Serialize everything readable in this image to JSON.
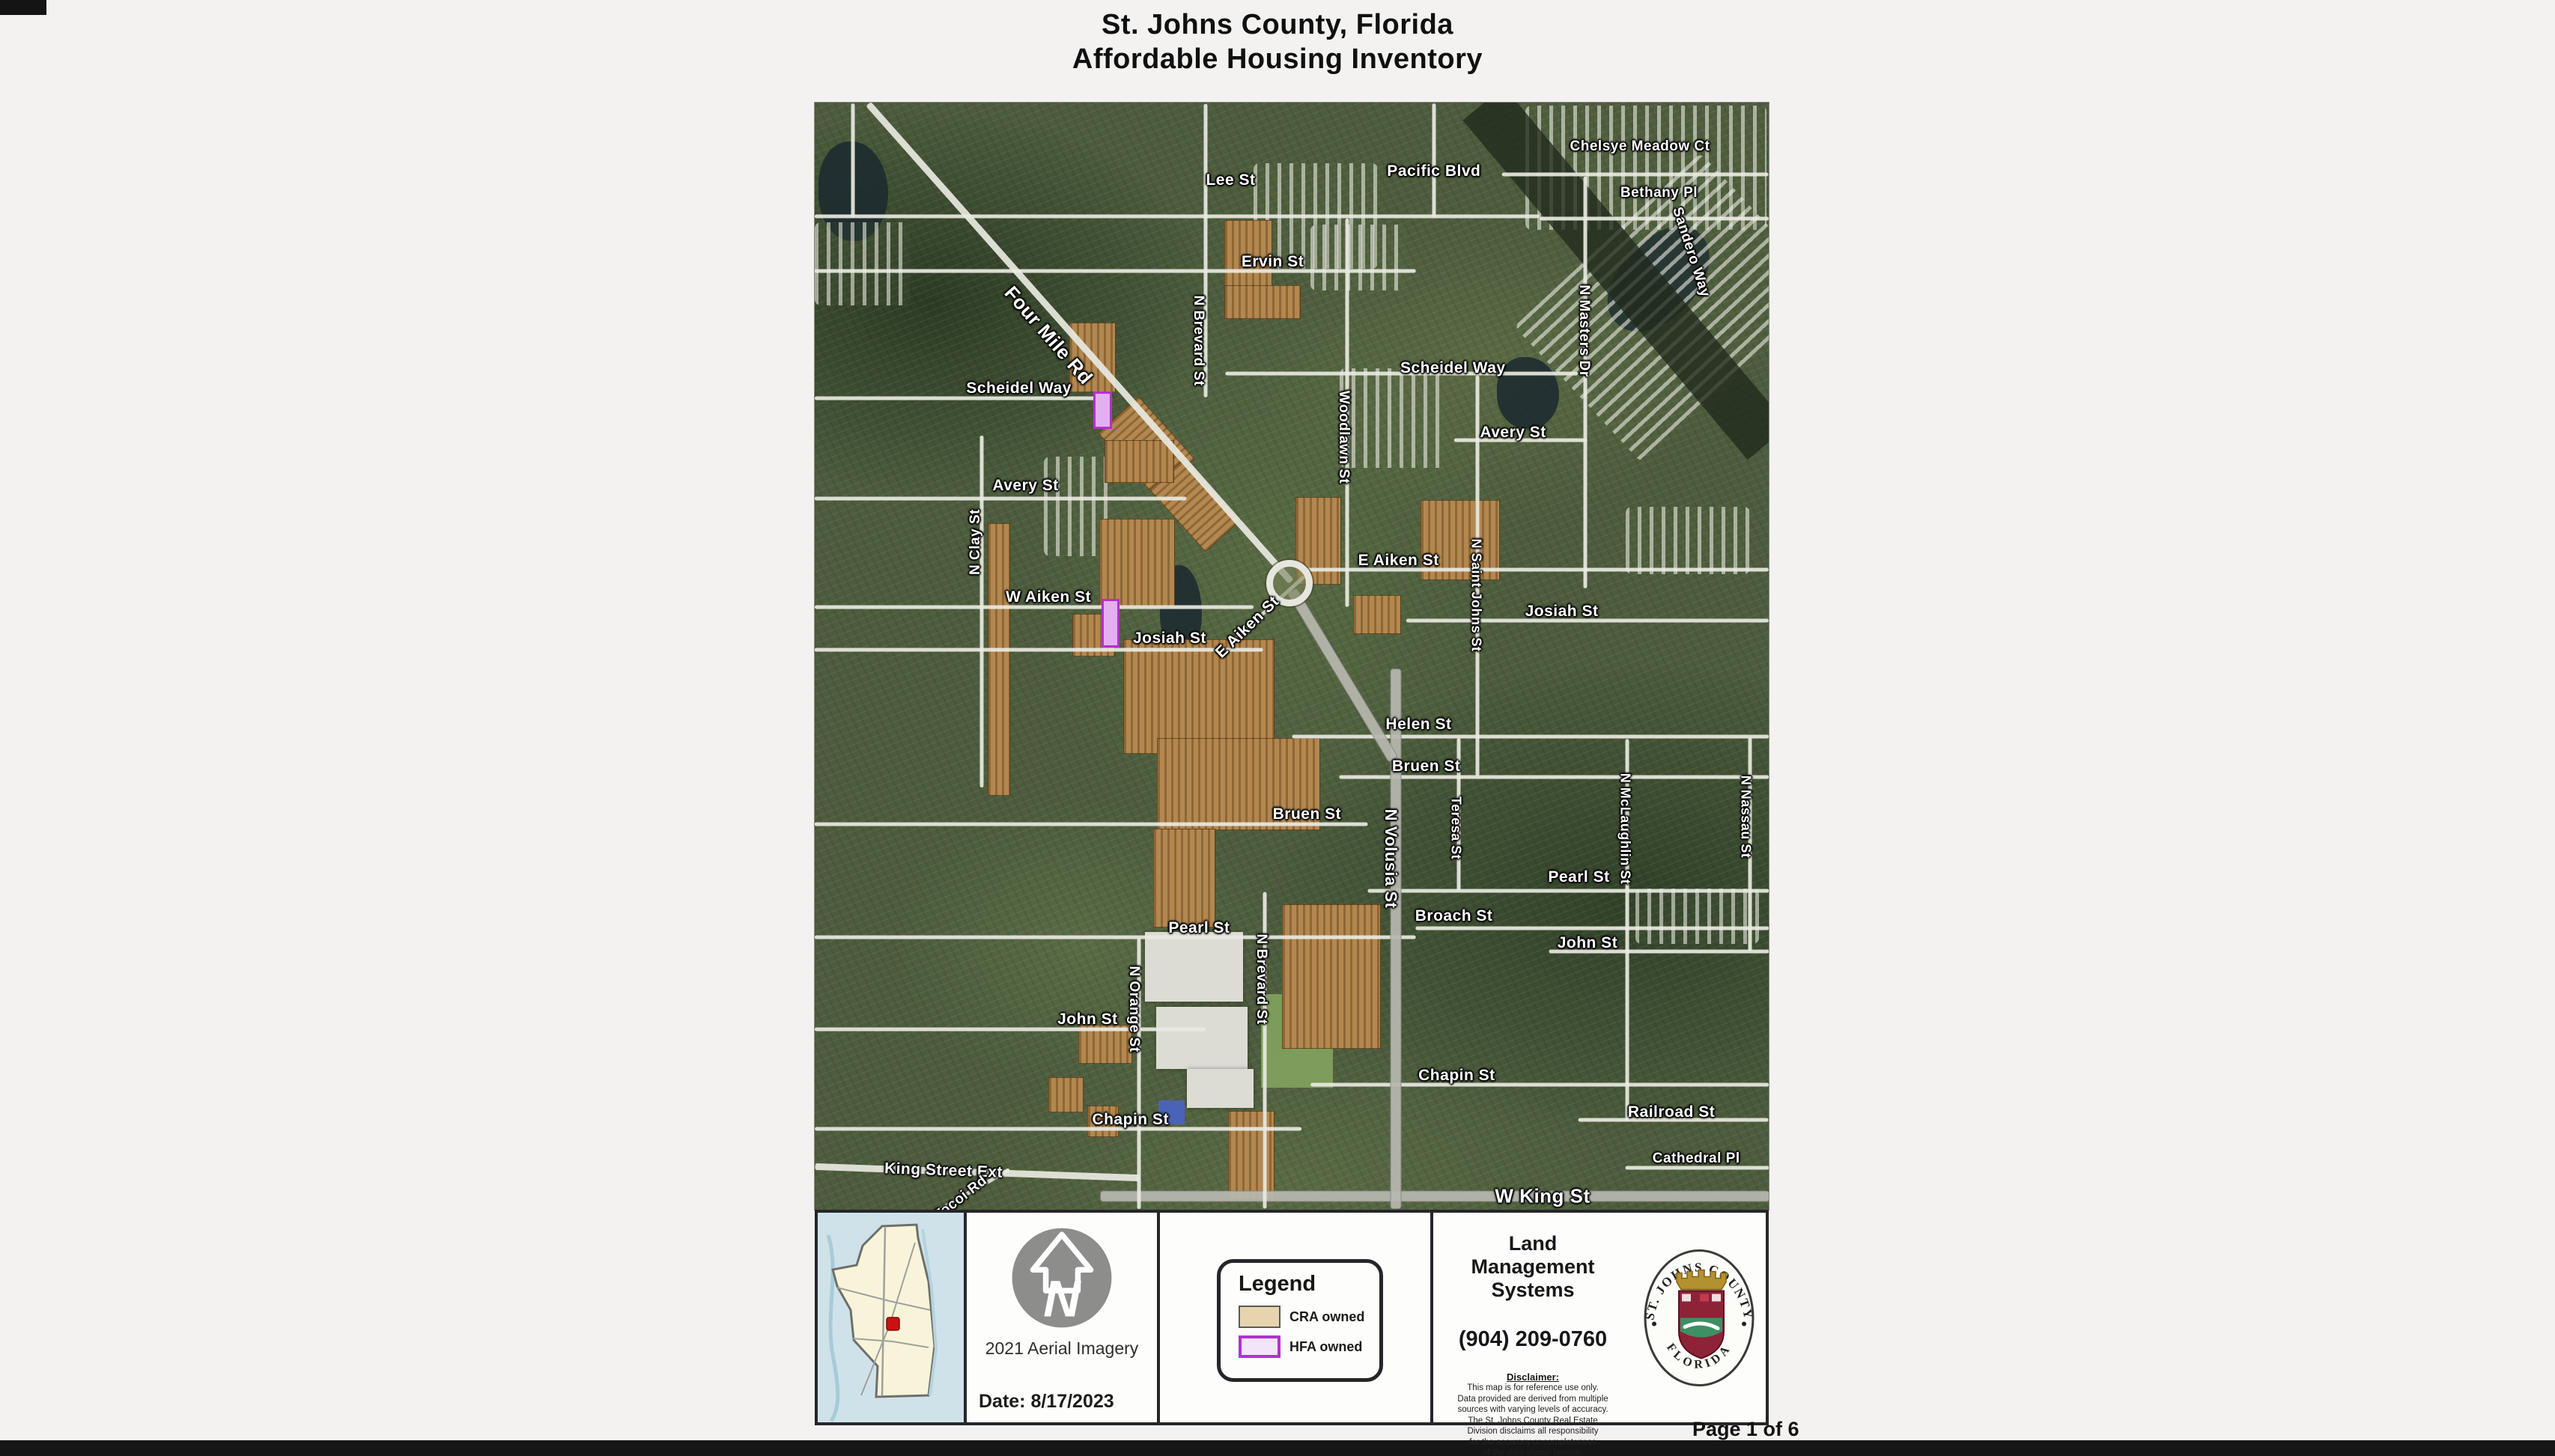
{
  "page": {
    "title_line1": "St. Johns County, Florida",
    "title_line2": "Affordable Housing Inventory",
    "page_number": "Page 1 of 6"
  },
  "colors": {
    "cra": "#ad7e41",
    "cra_legend": "#e7d4ae",
    "hfa_fill": "#e2b0ef",
    "hfa_border": "#b52fd0",
    "locator_marker": "#cc1111"
  },
  "map": {
    "roundabout": {
      "x": 49.8,
      "y": 43.4
    },
    "labels": [
      {
        "t": "Lee St",
        "x": 43.6,
        "y": 7.0
      },
      {
        "t": "Pacific Blvd",
        "x": 64.9,
        "y": 6.2
      },
      {
        "t": "Chelsye Meadow Ct",
        "x": 86.5,
        "y": 4.0,
        "s": 19
      },
      {
        "t": "Bethany Pl",
        "x": 88.5,
        "y": 8.2,
        "s": 19
      },
      {
        "t": "Sandero Way",
        "x": 91.8,
        "y": 13.5,
        "r": 72,
        "s": 19
      },
      {
        "t": "Ervin St",
        "x": 48.0,
        "y": 14.4
      },
      {
        "t": "Four Mile Rd",
        "x": 24.5,
        "y": 21.0,
        "r": 49,
        "s": 26
      },
      {
        "t": "Scheidel Way",
        "x": 21.4,
        "y": 25.8
      },
      {
        "t": "Scheidel Way",
        "x": 66.9,
        "y": 24.0
      },
      {
        "t": "N Brevard St",
        "x": 40.2,
        "y": 21.5,
        "r": 90,
        "s": 19
      },
      {
        "t": "Woodlawn St",
        "x": 55.4,
        "y": 30.2,
        "r": 90,
        "s": 19
      },
      {
        "t": "N Masters Dr",
        "x": 80.6,
        "y": 20.6,
        "r": 90,
        "s": 19
      },
      {
        "t": "Avery St",
        "x": 22.1,
        "y": 34.6
      },
      {
        "t": "Avery St",
        "x": 73.2,
        "y": 29.8
      },
      {
        "t": "N Clay St",
        "x": 16.9,
        "y": 39.7,
        "r": -90,
        "s": 19
      },
      {
        "t": "W Aiken St",
        "x": 24.5,
        "y": 44.7
      },
      {
        "t": "E Aiken St",
        "x": 61.2,
        "y": 41.4
      },
      {
        "t": "E Aiken St",
        "x": 45.4,
        "y": 47.4,
        "r": -44
      },
      {
        "t": "N Saint Johns St",
        "x": 69.3,
        "y": 44.5,
        "r": 90,
        "s": 18
      },
      {
        "t": "Josiah St",
        "x": 37.2,
        "y": 48.4
      },
      {
        "t": "Josiah St",
        "x": 78.3,
        "y": 46.0
      },
      {
        "t": "Helen St",
        "x": 63.3,
        "y": 56.2
      },
      {
        "t": "Bruen St",
        "x": 64.1,
        "y": 60.0
      },
      {
        "t": "Bruen St",
        "x": 51.6,
        "y": 64.3
      },
      {
        "t": "N Volusia St",
        "x": 60.4,
        "y": 68.3,
        "r": 90,
        "s": 22
      },
      {
        "t": "Teresa St",
        "x": 67.2,
        "y": 65.5,
        "r": 90,
        "s": 18
      },
      {
        "t": "Pearl St",
        "x": 80.1,
        "y": 70.0
      },
      {
        "t": "Pearl St",
        "x": 40.3,
        "y": 74.6
      },
      {
        "t": "Broach St",
        "x": 67.0,
        "y": 73.5
      },
      {
        "t": "N McLaughlin St",
        "x": 84.9,
        "y": 65.6,
        "r": 90,
        "s": 18
      },
      {
        "t": "N Nassau St",
        "x": 97.6,
        "y": 64.5,
        "r": 90,
        "s": 18
      },
      {
        "t": "John St",
        "x": 28.6,
        "y": 82.8
      },
      {
        "t": "John St",
        "x": 81.0,
        "y": 75.9
      },
      {
        "t": "N Orange St",
        "x": 33.4,
        "y": 81.9,
        "r": 90,
        "s": 19
      },
      {
        "t": "N Brevard St",
        "x": 46.8,
        "y": 79.2,
        "r": 90,
        "s": 19
      },
      {
        "t": "Chapin St",
        "x": 67.3,
        "y": 87.9
      },
      {
        "t": "Chapin St",
        "x": 33.1,
        "y": 91.9
      },
      {
        "t": "King Street Ext",
        "x": 13.5,
        "y": 96.5,
        "r": 2
      },
      {
        "t": "Tocoi Rd",
        "x": 15.3,
        "y": 99.0,
        "r": -38,
        "s": 19
      },
      {
        "t": "W King St",
        "x": 76.3,
        "y": 98.8,
        "s": 26
      },
      {
        "t": "Railroad St",
        "x": 89.8,
        "y": 91.2
      },
      {
        "t": "Cathedral Pl",
        "x": 92.4,
        "y": 95.4,
        "s": 19
      }
    ],
    "roads": [
      {
        "x": 38,
        "y": 10.3,
        "len": 76,
        "c": "m"
      },
      {
        "x": 31.5,
        "y": 15.2,
        "len": 63,
        "c": "m"
      },
      {
        "x": 15,
        "y": 26.7,
        "len": 30,
        "c": "m"
      },
      {
        "x": 61.5,
        "y": 24.5,
        "len": 37,
        "c": "m"
      },
      {
        "x": 19.5,
        "y": 35.8,
        "len": 39,
        "c": "m"
      },
      {
        "x": 74,
        "y": 30.5,
        "len": 14,
        "c": "m"
      },
      {
        "x": 23,
        "y": 45.6,
        "len": 46,
        "c": "m"
      },
      {
        "x": 75.5,
        "y": 42.2,
        "len": 49,
        "c": "m"
      },
      {
        "x": 23.5,
        "y": 49.4,
        "len": 47,
        "c": "m"
      },
      {
        "x": 81,
        "y": 46.8,
        "len": 38,
        "c": "m"
      },
      {
        "x": 75,
        "y": 57.3,
        "len": 50,
        "c": "m"
      },
      {
        "x": 77.5,
        "y": 60.9,
        "len": 45,
        "c": "m"
      },
      {
        "x": 29,
        "y": 65.2,
        "len": 58,
        "c": "m"
      },
      {
        "x": 79,
        "y": 71.2,
        "len": 42,
        "c": "m"
      },
      {
        "x": 31.5,
        "y": 75.4,
        "len": 63,
        "c": "m"
      },
      {
        "x": 81.5,
        "y": 74.6,
        "len": 37,
        "c": "m"
      },
      {
        "x": 20.5,
        "y": 83.7,
        "len": 41,
        "c": "m"
      },
      {
        "x": 88.5,
        "y": 76.7,
        "len": 23,
        "c": "m"
      },
      {
        "x": 25.5,
        "y": 92.7,
        "len": 51,
        "c": "m"
      },
      {
        "x": 76,
        "y": 88.7,
        "len": 48,
        "c": "m"
      },
      {
        "x": 90,
        "y": 91.9,
        "len": 20,
        "c": "m"
      },
      {
        "x": 92.5,
        "y": 96.2,
        "len": 15,
        "c": "m"
      },
      {
        "x": 17,
        "y": 96.6,
        "len": 34,
        "r": 2,
        "c": "M"
      },
      {
        "x": 65,
        "y": 98.8,
        "len": 70,
        "c": "h"
      },
      {
        "x": 86,
        "y": 6.5,
        "len": 28,
        "c": "m"
      },
      {
        "x": 88,
        "y": 10.5,
        "len": 24,
        "c": "m"
      },
      {
        "x": 64.9,
        "y": 5.2,
        "len": 11.9,
        "r": 90,
        "c": "m"
      },
      {
        "x": 4,
        "y": 5.2,
        "len": 11.9,
        "r": 90,
        "c": "m"
      },
      {
        "x": 17.5,
        "y": 46,
        "len": 36.9,
        "r": 90,
        "c": "m"
      },
      {
        "x": 41,
        "y": 13.4,
        "len": 30.8,
        "r": 90,
        "c": "m"
      },
      {
        "x": 55.8,
        "y": 28,
        "len": 40.7,
        "r": 90,
        "c": "m"
      },
      {
        "x": 69.5,
        "y": 42.7,
        "len": 42,
        "r": 90,
        "c": "m"
      },
      {
        "x": 67.5,
        "y": 64.3,
        "len": 16,
        "r": 90,
        "c": "m"
      },
      {
        "x": 80.8,
        "y": 25.3,
        "len": 43.2,
        "r": 90,
        "c": "m"
      },
      {
        "x": 85.2,
        "y": 74.7,
        "len": 40,
        "r": 90,
        "c": "m"
      },
      {
        "x": 98,
        "y": 67,
        "len": 22.4,
        "r": 90,
        "c": "m"
      },
      {
        "x": 34,
        "y": 87.7,
        "len": 28.4,
        "r": 90,
        "c": "m"
      },
      {
        "x": 47.2,
        "y": 85.6,
        "len": 33.2,
        "r": 90,
        "c": "m"
      },
      {
        "x": 60.9,
        "y": 75.5,
        "len": 56.5,
        "r": 90,
        "c": "h"
      },
      {
        "x": 27.8,
        "y": 21.7,
        "len": 66.9,
        "r": 48.5,
        "c": "M"
      },
      {
        "x": 55.3,
        "y": 51.7,
        "len": 20.6,
        "r": 59,
        "c": "h"
      },
      {
        "x": 47.5,
        "y": 45.8,
        "len": 10.4,
        "r": -42,
        "c": "m"
      },
      {
        "x": 16.5,
        "y": 98.3,
        "len": 9,
        "r": -30,
        "c": "m"
      }
    ],
    "parcels": [
      {
        "x": 42.9,
        "y": 10.6,
        "w": 4.9,
        "h": 8.8,
        "ty": "cra"
      },
      {
        "x": 42.9,
        "y": 16.5,
        "w": 7.9,
        "h": 2.9,
        "ty": "cra"
      },
      {
        "x": 26.7,
        "y": 19.9,
        "w": 4.7,
        "h": 6.1,
        "ty": "cra"
      },
      {
        "x": 30.4,
        "y": 28.5,
        "w": 8.6,
        "h": 4.8,
        "ty": "cra",
        "r": 48
      },
      {
        "x": 35.5,
        "y": 34.2,
        "w": 8.6,
        "h": 4.1,
        "ty": "cra",
        "r": 48
      },
      {
        "x": 18.1,
        "y": 38.0,
        "w": 2.2,
        "h": 24.5,
        "ty": "cra"
      },
      {
        "x": 30.4,
        "y": 30.5,
        "w": 7.1,
        "h": 3.7,
        "ty": "cra"
      },
      {
        "x": 29.8,
        "y": 37.6,
        "w": 7.8,
        "h": 7.8,
        "ty": "cra"
      },
      {
        "x": 27.0,
        "y": 46.2,
        "w": 4.3,
        "h": 3.7,
        "ty": "cra"
      },
      {
        "x": 50.4,
        "y": 35.6,
        "w": 4.6,
        "h": 7.8,
        "ty": "cra"
      },
      {
        "x": 63.5,
        "y": 35.9,
        "w": 8.2,
        "h": 7.1,
        "ty": "cra"
      },
      {
        "x": 56.4,
        "y": 44.5,
        "w": 4.9,
        "h": 3.4,
        "ty": "cra"
      },
      {
        "x": 32.3,
        "y": 48.5,
        "w": 15.7,
        "h": 10.2,
        "ty": "cra"
      },
      {
        "x": 35.9,
        "y": 57.4,
        "w": 16.9,
        "h": 8.2,
        "ty": "cra"
      },
      {
        "x": 35.5,
        "y": 65.6,
        "w": 6.3,
        "h": 8.8,
        "ty": "cra"
      },
      {
        "x": 49.0,
        "y": 72.4,
        "w": 10.2,
        "h": 12.9,
        "ty": "cra"
      },
      {
        "x": 27.6,
        "y": 83.3,
        "w": 5.5,
        "h": 3.4,
        "ty": "cra"
      },
      {
        "x": 24.5,
        "y": 88.0,
        "w": 3.5,
        "h": 3.1,
        "ty": "cra"
      },
      {
        "x": 43.3,
        "y": 91.1,
        "w": 4.7,
        "h": 7.8,
        "ty": "cra"
      },
      {
        "x": 28.6,
        "y": 90.6,
        "w": 3.1,
        "h": 2.7,
        "ty": "cra"
      },
      {
        "x": 29.2,
        "y": 26.1,
        "w": 1.5,
        "h": 3.0,
        "ty": "hfa"
      },
      {
        "x": 30.1,
        "y": 44.8,
        "w": 1.4,
        "h": 4.0,
        "ty": "hfa"
      }
    ],
    "water": [
      {
        "x": 0.4,
        "y": 3.5,
        "w": 7.3,
        "h": 9
      },
      {
        "x": 84.5,
        "y": 10.5,
        "w": 8,
        "h": 11,
        "r": 45
      },
      {
        "x": 71.5,
        "y": 23,
        "w": 6.5,
        "h": 6.5
      },
      {
        "x": 36.2,
        "y": 41.8,
        "w": 4.4,
        "h": 8.4
      }
    ],
    "textures": [
      {
        "x": 74.5,
        "y": 0.3,
        "w": 25.3,
        "h": 11.2,
        "cls": "rows"
      },
      {
        "x": 80,
        "y": 7,
        "w": 19.5,
        "h": 23,
        "cls": "rows",
        "r": 47
      },
      {
        "x": 85,
        "y": 15.4,
        "w": 46.5,
        "h": 4.8,
        "cls": "dark",
        "r": 50,
        "ctr": 1
      },
      {
        "x": 0,
        "y": 10.8,
        "w": 10,
        "h": 7.5,
        "cls": "rows"
      },
      {
        "x": 46,
        "y": 5.5,
        "w": 13,
        "h": 9.5,
        "cls": "rows"
      },
      {
        "x": 55,
        "y": 24,
        "w": 11,
        "h": 9,
        "cls": "rows"
      },
      {
        "x": 85,
        "y": 36.5,
        "w": 13,
        "h": 6.1,
        "cls": "rows"
      },
      {
        "x": 86,
        "y": 71,
        "w": 13,
        "h": 5,
        "cls": "rows"
      },
      {
        "x": 52,
        "y": 11,
        "w": 10,
        "h": 6,
        "cls": "rows"
      },
      {
        "x": 24,
        "y": 32,
        "w": 7,
        "h": 9,
        "cls": "rows"
      }
    ],
    "buildings": [
      {
        "x": 34.6,
        "y": 74.9,
        "w": 10.3,
        "h": 6.3,
        "cls": "bldg"
      },
      {
        "x": 35.8,
        "y": 81.7,
        "w": 9.6,
        "h": 5.6,
        "cls": "bldg"
      },
      {
        "x": 39.0,
        "y": 87.3,
        "w": 7.0,
        "h": 3.5,
        "cls": "bldg"
      },
      {
        "x": 46.8,
        "y": 80.5,
        "w": 7.5,
        "h": 8.5,
        "cls": "field"
      },
      {
        "x": 36.0,
        "y": 90.1,
        "w": 2.8,
        "h": 2.2,
        "cls": "blue-bldg"
      }
    ]
  },
  "footer": {
    "north": {
      "caption": "2021 Aerial Imagery",
      "date": "Date: 8/17/2023"
    },
    "legend": {
      "title": "Legend",
      "items": [
        {
          "label": "CRA owned",
          "type": "cra"
        },
        {
          "label": "HFA owned",
          "type": "hfa"
        }
      ]
    },
    "contact": {
      "org": "Land Management Systems",
      "phone": "(904) 209-0760",
      "disclaimer_title": "Disclaimer:",
      "disclaimer_lines": [
        "This map is for reference use only.",
        "Data provided are derived from multiple",
        "sources with varying levels of accuracy.",
        "The St. Johns County Real Estate",
        "Division disclaims all responsibility",
        "for the accuracy or completeness",
        "of the data shown hereon."
      ]
    },
    "seal": {
      "arc_top": "ST. JOHNS COUNTY",
      "arc_bottom": "FLORIDA"
    }
  }
}
